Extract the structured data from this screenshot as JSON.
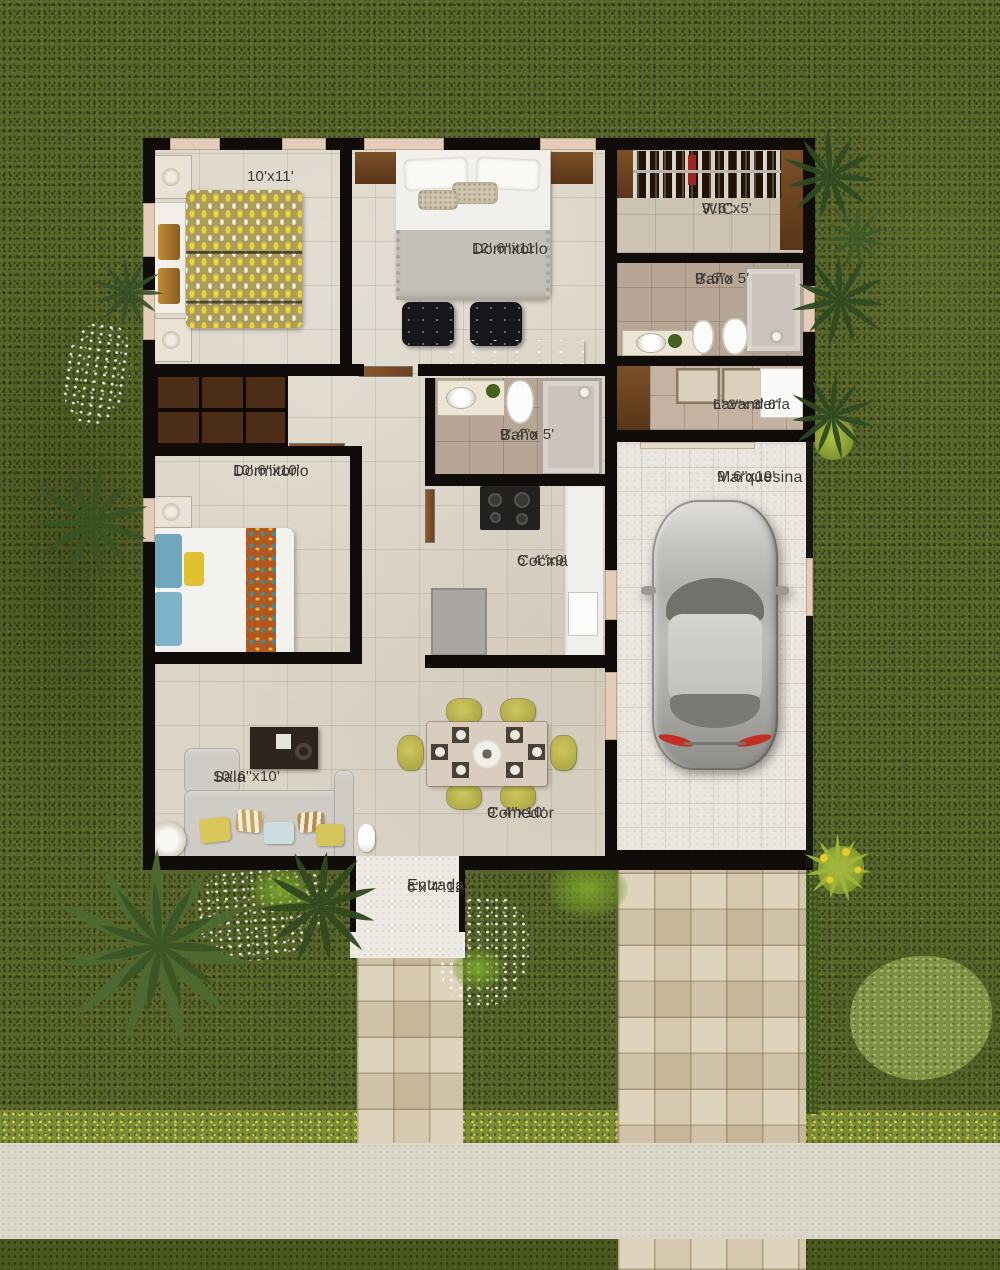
{
  "rooms": [
    {
      "id": "bedroom1",
      "name": "",
      "dims": "10'x11'"
    },
    {
      "id": "master_bedroom",
      "name": "Dormitorio",
      "dims": "12'.6''x11'"
    },
    {
      "id": "wic",
      "name": "WIC",
      "dims": "9'.6''x5'"
    },
    {
      "id": "bath1",
      "name": "Baño",
      "dims": "9'.6''x 5'"
    },
    {
      "id": "laundry",
      "name": "Lavandería",
      "dims": "6'.2''x 3'.6''"
    },
    {
      "id": "bath2",
      "name": "Baño",
      "dims": "9'.4''x 5'"
    },
    {
      "id": "bedroom2",
      "name": "Dormitorio",
      "dims": "10'.6''x10'"
    },
    {
      "id": "carport",
      "name": "Marquesina",
      "dims": "9'.6''x19'"
    },
    {
      "id": "kitchen",
      "name": "Cocina",
      "dims": "6'.4''x9'"
    },
    {
      "id": "living",
      "name": "Sala",
      "dims": "10'.6''x10'"
    },
    {
      "id": "dining",
      "name": "Comedor",
      "dims": "9'.4''x10'"
    },
    {
      "id": "entry",
      "name": "Entrada",
      "dims": "6'x 4'.12''"
    }
  ],
  "colors": {
    "grass": "#59662b",
    "wall": "#0f0c09",
    "floor": "#dbd4c7",
    "bath_floor": "#b7a695",
    "tile_path": "#d6c9ad",
    "sidewalk": "#dbd7cb",
    "wood": "#7c5128",
    "sofa": "#cfccc6",
    "dining_chair": "#c3be54",
    "bed_blanket_yellow": "#eed431",
    "car_silver": "#b2b0ad",
    "label_text": "#3c3935"
  }
}
